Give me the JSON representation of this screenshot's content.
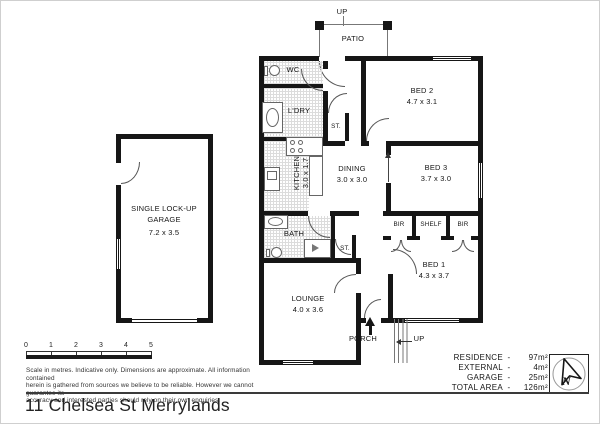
{
  "plan": {
    "patio": {
      "label": "PATIO",
      "up": "UP"
    },
    "rooms": {
      "wc": "WC",
      "ldry": "L'DRY",
      "st_top": "ST.",
      "kitchen": {
        "name": "KITCHEN",
        "dim": "3.0 x 1.7"
      },
      "dining": {
        "name": "DINING",
        "dim": "3.0 x 3.0"
      },
      "bed2": {
        "name": "BED 2",
        "dim": "4.7 x 3.1"
      },
      "bed3": {
        "name": "BED 3",
        "dim": "3.7 x 3.0"
      },
      "bath": "BATH",
      "st_bottom": "ST.",
      "bir_left": "BIR",
      "shelf": "SHELF",
      "bir_right": "BIR",
      "bed1": {
        "name": "BED 1",
        "dim": "4.3 x 3.7"
      },
      "lounge": {
        "name": "LOUNGE",
        "dim": "4.0 x 3.6"
      },
      "garage": {
        "line1": "SINGLE LOCK-UP",
        "line2": "GARAGE",
        "dim": "7.2 x 3.5"
      }
    },
    "porch": {
      "label": "PORCH",
      "up": "UP"
    }
  },
  "scale_bar": {
    "ticks": [
      "0",
      "1",
      "2",
      "3",
      "4",
      "5"
    ]
  },
  "disclaimer": {
    "line1": "Scale in metres. Indicative only. Dimensions are approximate. All information contained",
    "line2": "herein is gathered from sources we believe to be reliable. However we cannot guarantee its",
    "line3": "accuracy and interested parties should rely on their own enquiries."
  },
  "area_table": {
    "rows": [
      {
        "label": "RESIDENCE",
        "dash": "-",
        "value": "97m²"
      },
      {
        "label": "EXTERNAL",
        "dash": "-",
        "value": "4m²"
      },
      {
        "label": "GARAGE",
        "dash": "-",
        "value": "25m²"
      },
      {
        "label": "TOTAL AREA",
        "dash": "-",
        "value": "126m²"
      }
    ]
  },
  "compass": {
    "label": "N"
  },
  "address": "11 Chelsea St Merrylands",
  "colors": {
    "wall": "#161616",
    "hatch_line": "#dcdcdc",
    "thin_line": "#666666"
  }
}
